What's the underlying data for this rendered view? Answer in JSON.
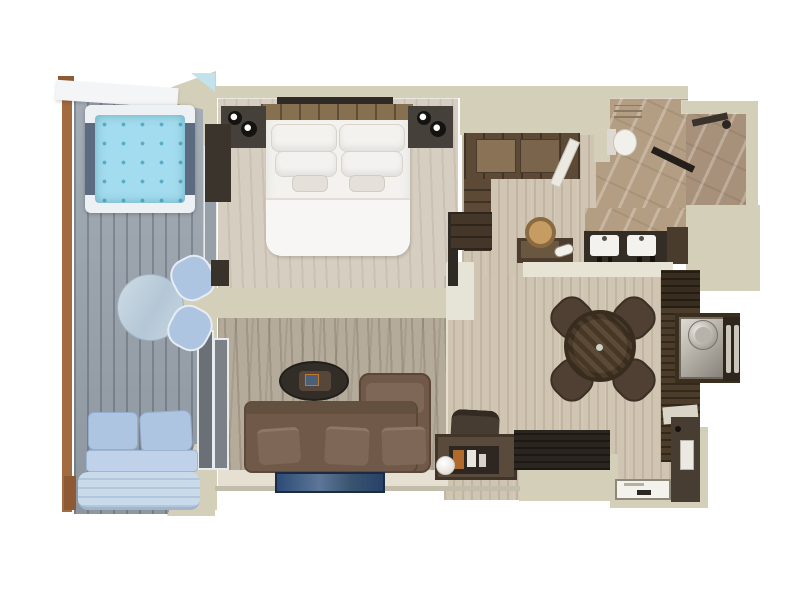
{
  "figure": {
    "kind": "floor-plan",
    "view": "top-down-3d-render",
    "background": "#ffffff"
  },
  "palette": {
    "wall": "#d3cfb9",
    "deck": "#9aa3ad",
    "rail_wood": "#a26b40",
    "water": "#a3dcee",
    "tub_rim": "#edf1f3",
    "tub_side": "#5c6b80",
    "balcony_fabric": "#aec5e2",
    "balcony_seat": "#bfd2e9",
    "sky_glint": "#c2e2ec",
    "bedroom_floor": "#d6cec0",
    "bed_linen": "#f3f2ef",
    "headboard": "#87704f",
    "nightstand": "#45403a",
    "artwork": "#2e2a25",
    "carpet": "#b5ab9b",
    "living_floor": "#e6e0d3",
    "sofa": "#71594a",
    "cushion": "#7e6757",
    "coffee_table": "#332d27",
    "rug_border": "#18263c",
    "wood_floor": "#cfc5b2",
    "chair": "#4f4033",
    "counter": "#4c3d2b",
    "counter_top": "#382d1e",
    "marble": "#b49e83",
    "marble_dark": "#a8917a",
    "vanity": "#332d26",
    "sink": "#f4f2ee",
    "closet_wood": "#5d4a36",
    "shelf_dark": "#44372a",
    "stool_seat": "#c79c63",
    "entry_wall": "#473d33",
    "door_white": "#ebe9e1",
    "mat": "#f4f2ec",
    "dark_cabinet": "#2b2520",
    "endcap": "#e6e3d7",
    "band_light": "#e7e3d5"
  },
  "rooms": {
    "balcony": {
      "label": "Private balcony",
      "items": [
        "plunge-pool",
        "round-table",
        "two-chairs",
        "outdoor-sofa",
        "lounger"
      ]
    },
    "bedroom": {
      "label": "Bedroom",
      "items": [
        "king-bed",
        "two-nightstands",
        "reading-lamps",
        "wall-art",
        "tv",
        "cabinet",
        "bench"
      ]
    },
    "closet": {
      "label": "Walk-in closet",
      "items": [
        "wardrobe",
        "shelving",
        "vanity-desk",
        "stool",
        "hairdryer"
      ]
    },
    "bathroom": {
      "label": "Bathroom",
      "items": [
        "double-sink-vanity",
        "toilet",
        "walk-in-shower",
        "glass-partition",
        "towel-shelf"
      ]
    },
    "living": {
      "label": "Living area",
      "items": [
        "sectional-sofa",
        "oval-coffee-table",
        "blue-rug",
        "console-with-bottles",
        "desk-chair",
        "sphere-lamp"
      ]
    },
    "dining": {
      "label": "Dining area",
      "items": [
        "round-dining-table",
        "four-chairs",
        "bar-counter",
        "bar-sink",
        "ice-bucket"
      ]
    },
    "entry": {
      "label": "Entry hall",
      "items": [
        "entrance-door",
        "door-mat",
        "luggage-cabinet"
      ]
    }
  }
}
